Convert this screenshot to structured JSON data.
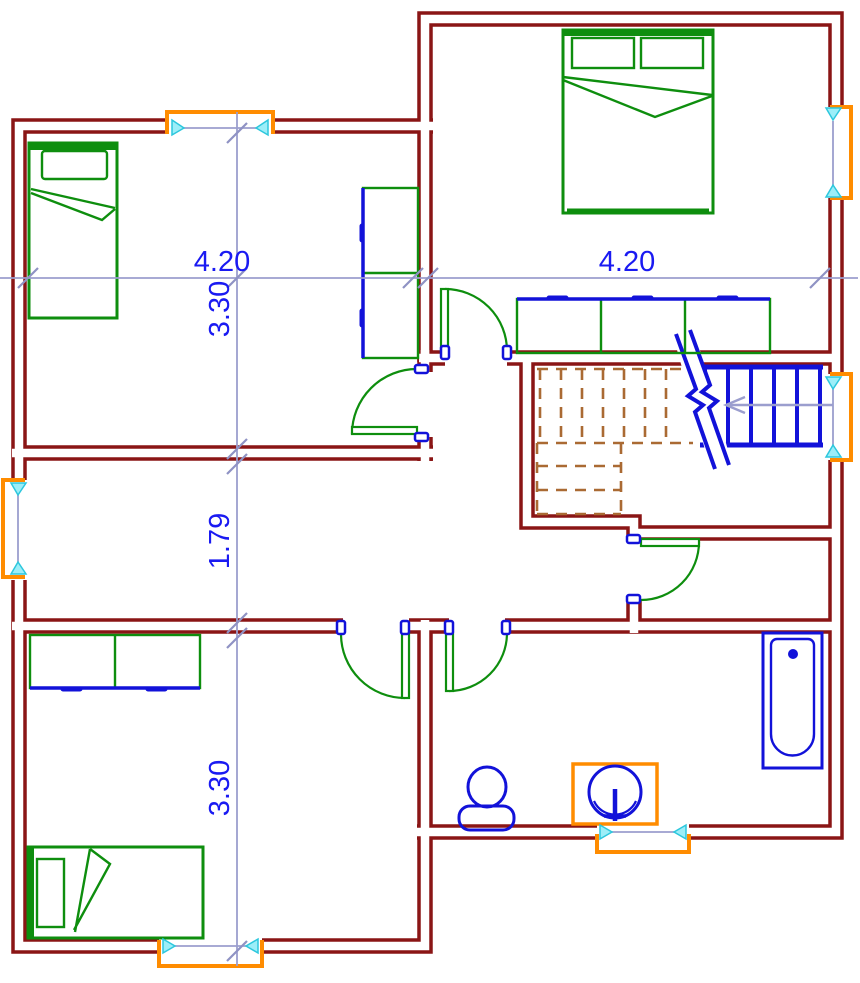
{
  "drawing": {
    "type": "architectural floor plan",
    "view": "upper floor with staircase cut"
  },
  "dimensions": {
    "left_width": "4.20",
    "right_width": "4.20",
    "top_room_height": "3.30",
    "corridor_height": "1.79",
    "bottom_room_height": "3.30"
  },
  "colors": {
    "walls": "#8a1515",
    "furniture": "#0e8e0e",
    "fixtures_and_stairs": "#1212d9",
    "windows": "#ff8c00",
    "window_markers": "#9ceef8",
    "hidden_stairs": "#aa6a33",
    "dimension_lines": "#9b9ece",
    "dimension_text": "#1a1af2",
    "background": "#ffffff"
  },
  "elements": {
    "rooms": [
      "bedroom-top-left",
      "bedroom-top-right",
      "hall",
      "stairwell",
      "corridor",
      "storage-room",
      "bedroom-bottom-left",
      "bathroom"
    ],
    "furniture": [
      "single-bed",
      "double-bed",
      "tall-wardrobe",
      "three-door-wardrobe",
      "low-wardrobe",
      "single-bed",
      "bathtub",
      "toilet",
      "sink-vanity"
    ],
    "stairs": {
      "visible_flight": "solid blue",
      "hidden_flight": "brown dashed",
      "direction_arrow": "points left"
    }
  }
}
